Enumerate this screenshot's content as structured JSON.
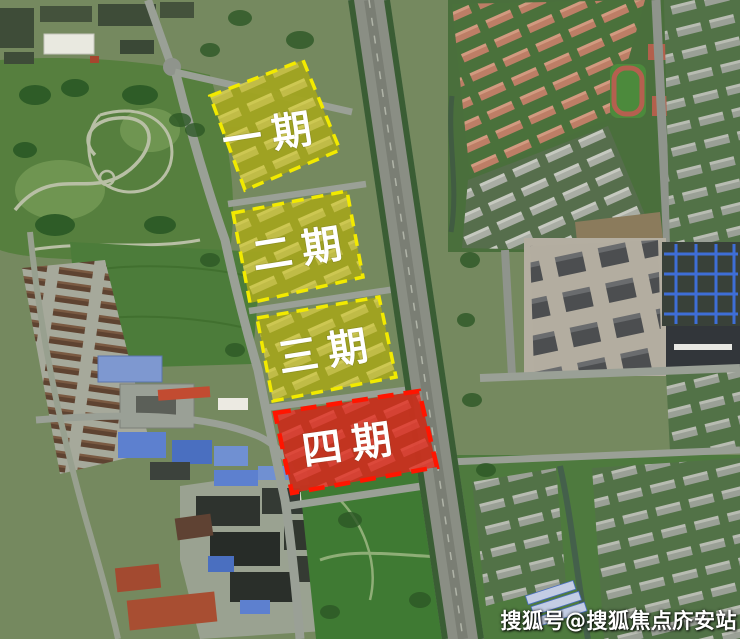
{
  "map": {
    "kind": "satellite-aerial-photo",
    "description": "aerial map of residential development phases",
    "zones": [
      {
        "id": "phase-1",
        "label": "一期",
        "fill": "#d8cc00",
        "border": "#f2ea00",
        "label_color": "#ffffff"
      },
      {
        "id": "phase-2",
        "label": "二期",
        "fill": "#d8cc00",
        "border": "#f2ea00",
        "label_color": "#ffffff"
      },
      {
        "id": "phase-3",
        "label": "三期",
        "fill": "#d8cc00",
        "border": "#f2ea00",
        "label_color": "#ffffff"
      },
      {
        "id": "phase-4",
        "label": "四期",
        "fill": "#e62012",
        "border": "#ff1500",
        "label_color": "#ffffff"
      }
    ],
    "watermark": {
      "text": "搜狐号@搜狐焦点庎安站",
      "color": "#ffffff"
    }
  }
}
